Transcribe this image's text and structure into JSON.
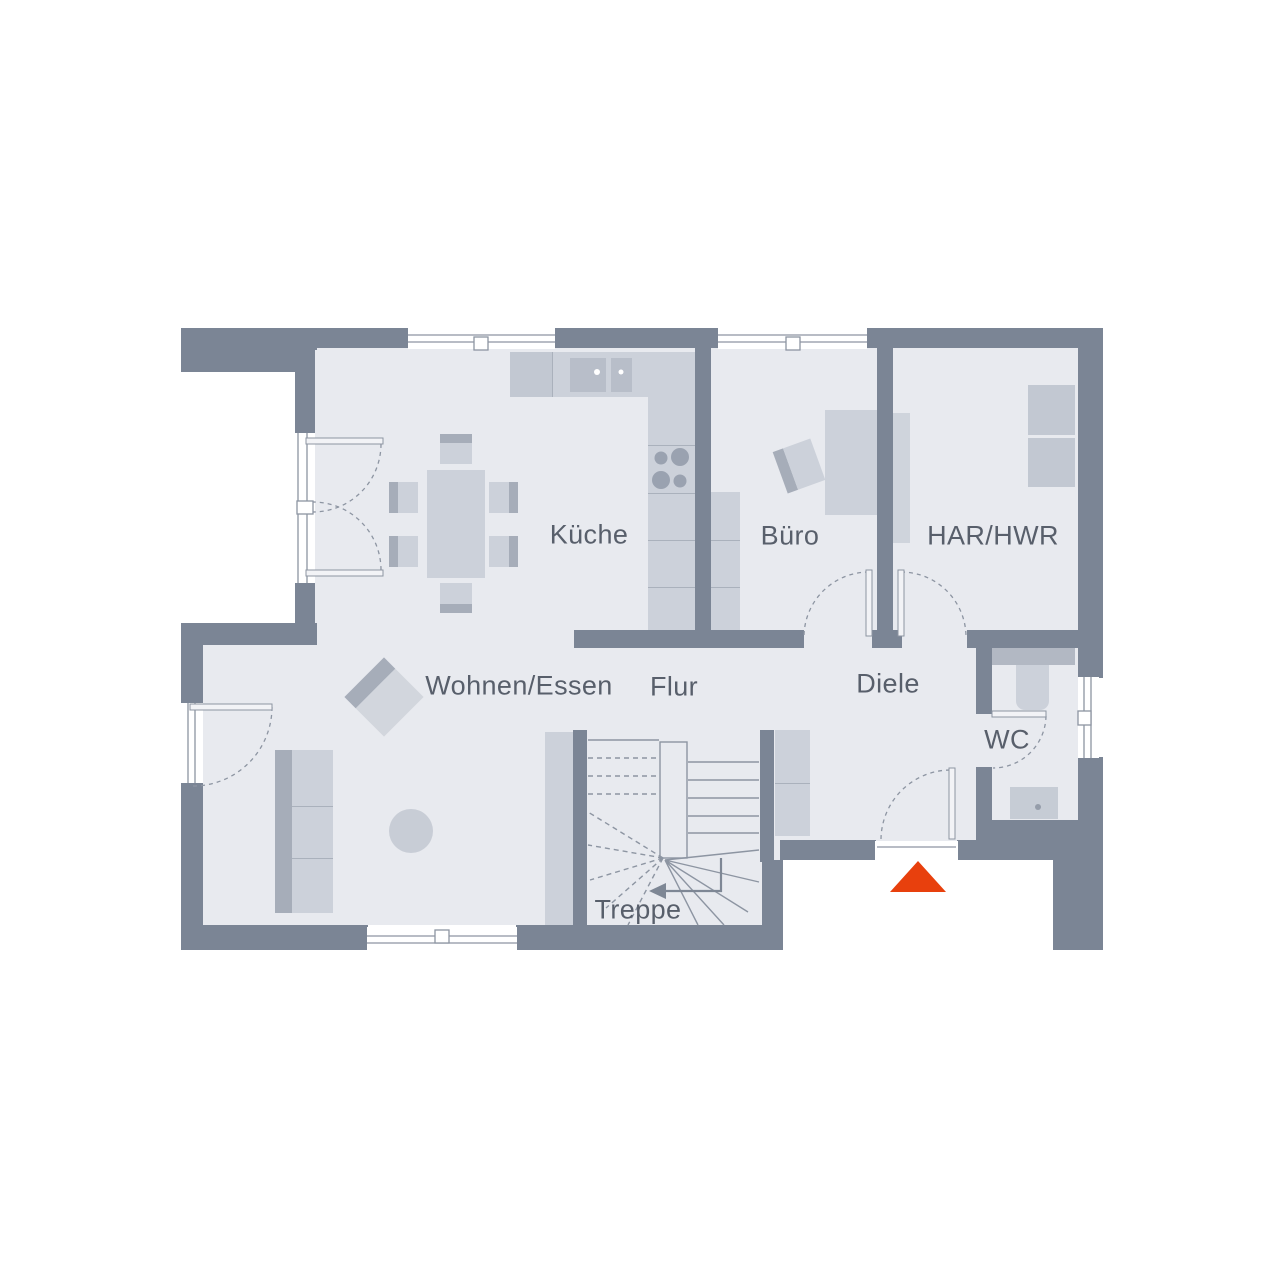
{
  "rooms": {
    "kueche": "Küche",
    "buero": "Büro",
    "har_hwr": "HAR/HWR",
    "wohnen_essen": "Wohnen/Essen",
    "flur": "Flur",
    "diele": "Diele",
    "wc": "WC",
    "treppe": "Treppe"
  },
  "colors": {
    "wall": "#7b8595",
    "floor": "#e8eaef",
    "furniture": "#ccd1da",
    "furniture_accent": "#a6adb9",
    "line": "#8d95a2",
    "label_text": "#585f6b",
    "entrance_marker": "#e8400d"
  }
}
